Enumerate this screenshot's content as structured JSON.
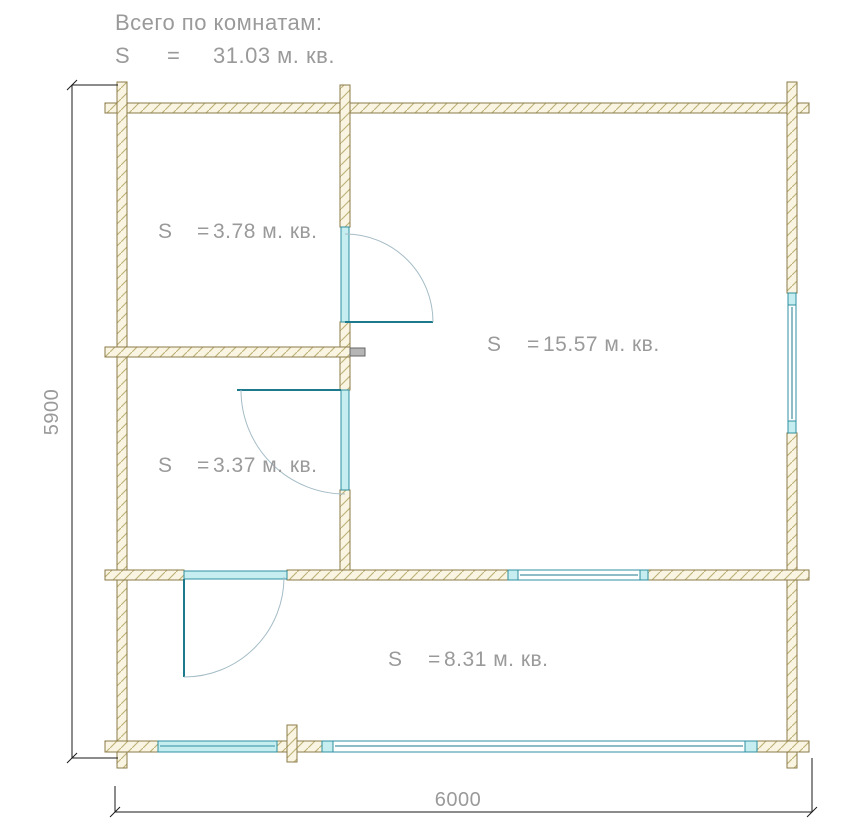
{
  "header": {
    "title": "Всего по комнатам:",
    "total": {
      "s": "S",
      "eq": "=",
      "value": "31.03 м. кв."
    }
  },
  "rooms": [
    {
      "name": "top-left-room",
      "s": "S",
      "eq": "=",
      "value": "3.78 м. кв."
    },
    {
      "name": "main-room",
      "s": "S",
      "eq": "=",
      "value": "15.57 м. кв."
    },
    {
      "name": "mid-left-room",
      "s": "S",
      "eq": "=",
      "value": "3.37 м. кв."
    },
    {
      "name": "bottom-room",
      "s": "S",
      "eq": "=",
      "value": "8.31 м. кв."
    }
  ],
  "dimensions": {
    "height": "5900",
    "width": "6000"
  },
  "colors": {
    "wall_outline": "#8b7a4a",
    "wall_fill": "#f9f5e2",
    "wall_hatch": "#bdb077",
    "window_teal": "#2f8fa0",
    "window_fill_light": "#c6eef1",
    "window_inner_line": "#1d7a8c",
    "door_leaf": "#1d7a8c",
    "door_arc": "#a5bcc6",
    "text_gray": "#9a9a9a",
    "dimension_black": "#1a1a1a",
    "stub_gray": "#b5b5b5"
  }
}
